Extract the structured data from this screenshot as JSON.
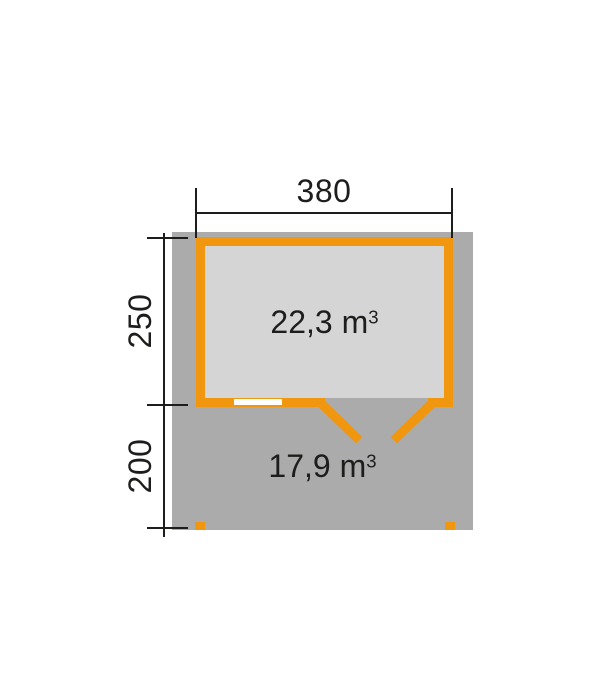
{
  "diagram": {
    "title": "garden-house-floor-plan",
    "top_width_label": "380",
    "left_height_room_label": "250",
    "left_height_terrace_label": "200",
    "room_volume_value": "22,3",
    "terrace_volume_value": "17,9",
    "volume_unit": "m",
    "volume_exponent": "3",
    "colors": {
      "wall_orange": "#F0960F",
      "terrace_gray": "#ABABAB",
      "room_gray": "#D5D5D5",
      "dimension": "#1D1D1B",
      "window_white": "#FFFFFF",
      "background": "#FFFFFF"
    }
  }
}
